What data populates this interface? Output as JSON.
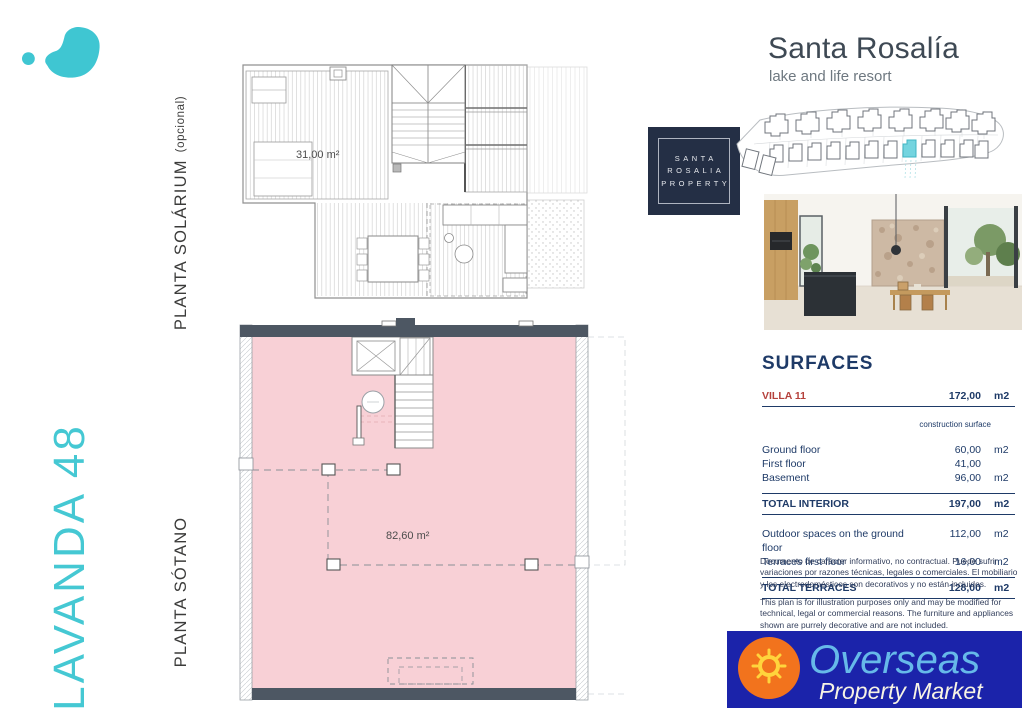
{
  "branding": {
    "resort_title": "Santa Rosalía",
    "resort_subtitle": "lake and life resort",
    "property_logo_lines": [
      "SANTA",
      "ROSALIA",
      "PROPERTY"
    ]
  },
  "left_labels": {
    "villa_name": "LAVANDA 48",
    "solarium": "PLANTA SOLÁRIUM",
    "solarium_suffix": "(opcional)",
    "sotano": "PLANTA SÓTANO"
  },
  "plans": {
    "solarium_area": "31,00 m²",
    "basement_area": "82,60 m²"
  },
  "surfaces": {
    "title": "SURFACES",
    "villa_label": "VILLA 11",
    "villa_total": "172,00",
    "villa_unit": "m2",
    "col_header": "construction surface",
    "rows": [
      {
        "label": "Ground floor",
        "value": "60,00",
        "unit": "m2"
      },
      {
        "label": "First floor",
        "value": "41,00",
        "unit": ""
      },
      {
        "label": "Basement",
        "value": "96,00",
        "unit": "m2"
      }
    ],
    "total_interior": {
      "label": "TOTAL INTERIOR",
      "value": "197,00",
      "unit": "m2"
    },
    "outdoor_rows": [
      {
        "label": "Outdoor spaces on the ground floor",
        "value": "112,00",
        "unit": "m2"
      },
      {
        "label": "Terraces first floor",
        "value": "16,00",
        "unit": "m2"
      }
    ],
    "total_terraces": {
      "label": "TOTAL TERRACES",
      "value": "128,00",
      "unit": "m2"
    }
  },
  "disclaimer": {
    "es": "Documento de carácter informativo, no contractual. Puede sufrir variaciones por razones técnicas, legales o comerciales. El mobiliario y los electrodomésticos son decorativos y no están incluidos.",
    "en": "This plan is for illustration purposes only and may be modified for technical, legal or commercial reasons. The furniture and appliances shown are purrely decorative and are not included."
  },
  "footer_logo": {
    "line1": "Overseas",
    "line2": "Property Market"
  },
  "colors": {
    "brand_teal": "#3fc6d2",
    "basement_pink": "#f8d0d6",
    "wall_slate": "#4d5763",
    "table_navy": "#1e3a67",
    "villa_red": "#b5413c",
    "footer_blue": "#1b23aa",
    "footer_orange": "#f2731d",
    "footer_yellow": "#ffd43c",
    "footer_lightblue": "#66b9e9"
  }
}
